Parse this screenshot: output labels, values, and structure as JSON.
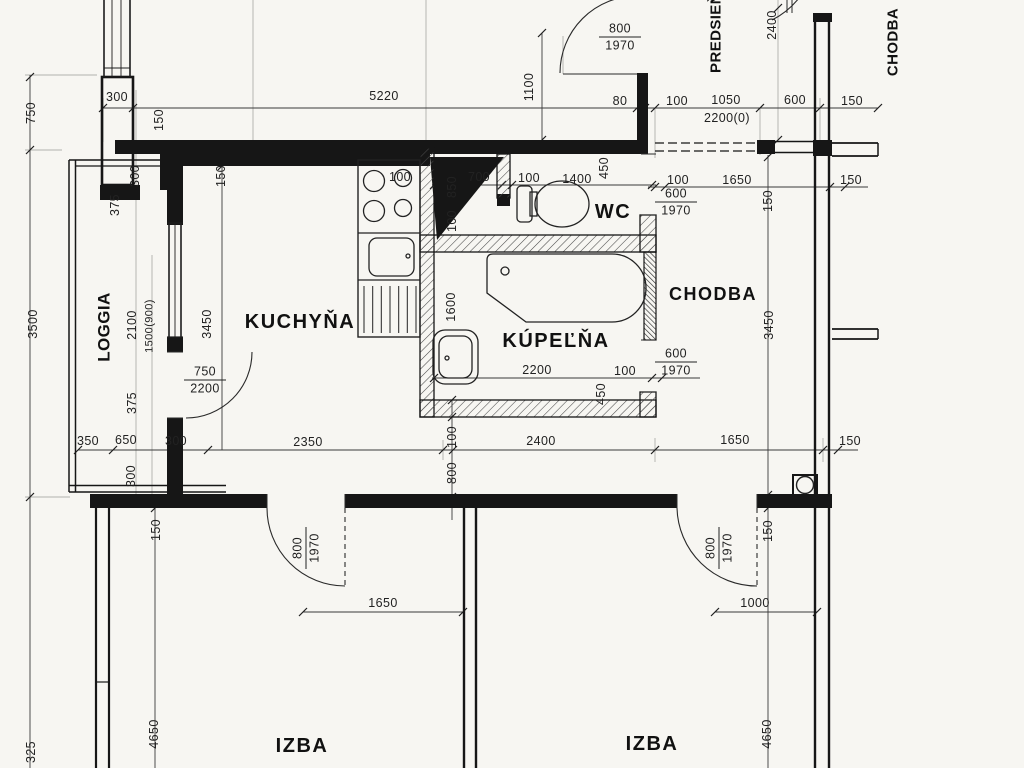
{
  "rooms": {
    "kitchen": "KUCHYŇA",
    "bathroom": "KÚPEĽŇA",
    "wc": "WC",
    "hallway": "CHODBA",
    "entry_hall": "PREDSIEŇ",
    "loggia": "LOGGIA",
    "building_corridor": "CHODBA",
    "room_left": "IZBA",
    "room_right": "IZBA"
  },
  "dims": {
    "d80": "80",
    "d100": "100",
    "d150": "150",
    "d300": "300",
    "d325": "325",
    "d350": "350",
    "d375": "375",
    "d450": "450",
    "d600": "600",
    "d650": "650",
    "d700": "700",
    "d750": "750",
    "d800": "800",
    "d850": "850",
    "d1000": "1000",
    "d1050": "1050",
    "d1100": "1100",
    "d1400": "1400",
    "d1500_900": "1500(900)",
    "d1600": "1600",
    "d1650": "1650",
    "d1970": "1970",
    "d2100": "2100",
    "d2200": "2200",
    "d2200_0": "2200(0)",
    "d2350": "2350",
    "d2400": "2400",
    "d3450": "3450",
    "d3500": "3500",
    "d4650": "4650",
    "d5220": "5220"
  }
}
